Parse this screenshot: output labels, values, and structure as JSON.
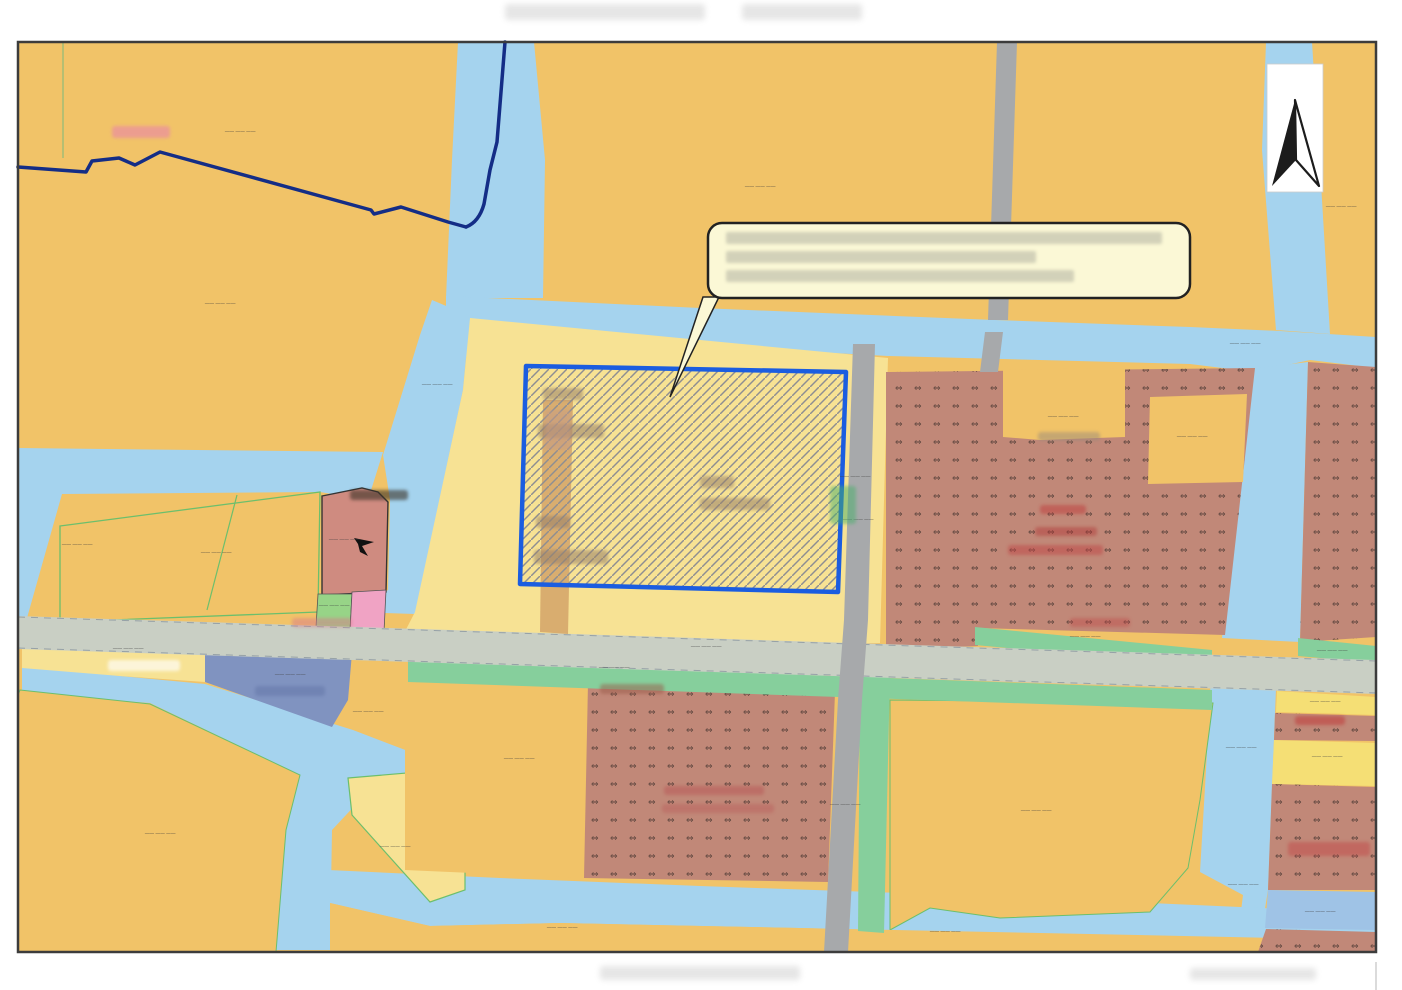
{
  "map": {
    "kind": "land-use-planning-map",
    "palette": {
      "farmland_orange": "#f1c368",
      "pale_yellow": "#f7e294",
      "bright_yellow": "#f5df75",
      "water_blue": "#a5d3ee",
      "village_brown": "#c18878",
      "village_glyph_color": "#463630",
      "green_strip": "#86cf9c",
      "slate_blue": "#8093c0",
      "parcel_blue": "#9fc3e6",
      "salmon": "#cf8b80",
      "small_green": "#97d487",
      "small_pink": "#f0a3c4",
      "road_main": "#c9cfc4",
      "road_secondary": "#a7a9ab",
      "road_edge_dash": "#8a96a0",
      "tan_path": "#d4a368",
      "navy_boundary": "#142d86",
      "subject_fill": "#f7e293",
      "subject_border": "#1b5de0",
      "hatch_line": "#8e8e92",
      "callout_fill": "#fbf8d6",
      "callout_border": "#222222",
      "label_color": "#3f3f3f",
      "frame": "#3c3c3c"
    },
    "village_pattern_glyph": "⇔",
    "north_arrow": {
      "icon": "north-arrow",
      "style": "half-filled-black-white"
    },
    "callout": {
      "legible": false,
      "line_count": 3,
      "bars": [
        [
          726,
          232,
          436,
          12
        ],
        [
          726,
          251,
          310,
          12
        ],
        [
          726,
          270,
          348,
          12
        ]
      ]
    },
    "subject_parcel": {
      "pattern": "diagonal-hatch",
      "text_legible": false,
      "text_blobs": [
        [
          543,
          388,
          40,
          12
        ],
        [
          538,
          424,
          66,
          14
        ],
        [
          700,
          476,
          34,
          12
        ],
        [
          700,
          498,
          70,
          12
        ],
        [
          536,
          516,
          34,
          12
        ],
        [
          534,
          550,
          74,
          14
        ]
      ]
    },
    "parcel_code_labels": {
      "glyph": "—— —— ——",
      "legible": false,
      "positions": [
        [
          240,
          133
        ],
        [
          760,
          188
        ],
        [
          1341,
          208
        ],
        [
          220,
          305
        ],
        [
          1245,
          345
        ],
        [
          437,
          386
        ],
        [
          1063,
          418
        ],
        [
          1192,
          438
        ],
        [
          855,
          478
        ],
        [
          858,
          521
        ],
        [
          344,
          541
        ],
        [
          77,
          546
        ],
        [
          216,
          554
        ],
        [
          334,
          607
        ],
        [
          128,
          650
        ],
        [
          1332,
          652
        ],
        [
          1085,
          638
        ],
        [
          614,
          669
        ],
        [
          290,
          676
        ],
        [
          706,
          648
        ],
        [
          1325,
          703
        ],
        [
          368,
          713
        ],
        [
          1241,
          749
        ],
        [
          1327,
          758
        ],
        [
          519,
          760
        ],
        [
          845,
          806
        ],
        [
          160,
          835
        ],
        [
          395,
          848
        ],
        [
          1036,
          812
        ],
        [
          1243,
          886
        ],
        [
          1320,
          913
        ],
        [
          562,
          929
        ],
        [
          945,
          933
        ]
      ]
    },
    "smudges": [
      [
        112,
        126,
        58,
        12,
        "#e87fb0",
        0.55
      ],
      [
        108,
        660,
        72,
        11,
        "#ffffff",
        0.65
      ],
      [
        292,
        618,
        60,
        9,
        "#d97a8a",
        0.5
      ],
      [
        600,
        684,
        64,
        10,
        "#9a5a48",
        0.5
      ],
      [
        664,
        786,
        100,
        9,
        "#b5494e",
        0.4
      ],
      [
        662,
        804,
        112,
        9,
        "#b5494e",
        0.3
      ],
      [
        1040,
        505,
        46,
        9,
        "#c03a3a",
        0.5
      ],
      [
        1035,
        527,
        62,
        9,
        "#b03535",
        0.45
      ],
      [
        1008,
        545,
        95,
        10,
        "#c04545",
        0.5
      ],
      [
        1070,
        618,
        60,
        9,
        "#c04545",
        0.4
      ],
      [
        830,
        486,
        26,
        38,
        "#49b06a",
        0.5
      ],
      [
        1295,
        716,
        50,
        9,
        "#c03a3a",
        0.55
      ],
      [
        1288,
        842,
        82,
        14,
        "#c24848",
        0.5
      ],
      [
        255,
        686,
        70,
        10,
        "#5a6da0",
        0.4
      ],
      [
        1038,
        432,
        62,
        9,
        "#9a8a7a",
        0.5
      ],
      [
        350,
        490,
        58,
        10,
        "#3a3028",
        0.6
      ],
      [
        545,
        410,
        26,
        40,
        "#c59a86",
        0.5
      ],
      [
        993,
        230,
        12,
        50,
        "#7fc8c0",
        0.5
      ]
    ],
    "margin_marks": {
      "top": [
        [
          505,
          4,
          200,
          16
        ],
        [
          742,
          4,
          120,
          16
        ]
      ],
      "bottom": [
        [
          600,
          966,
          200,
          14
        ],
        [
          1190,
          968,
          126,
          12
        ]
      ]
    }
  }
}
